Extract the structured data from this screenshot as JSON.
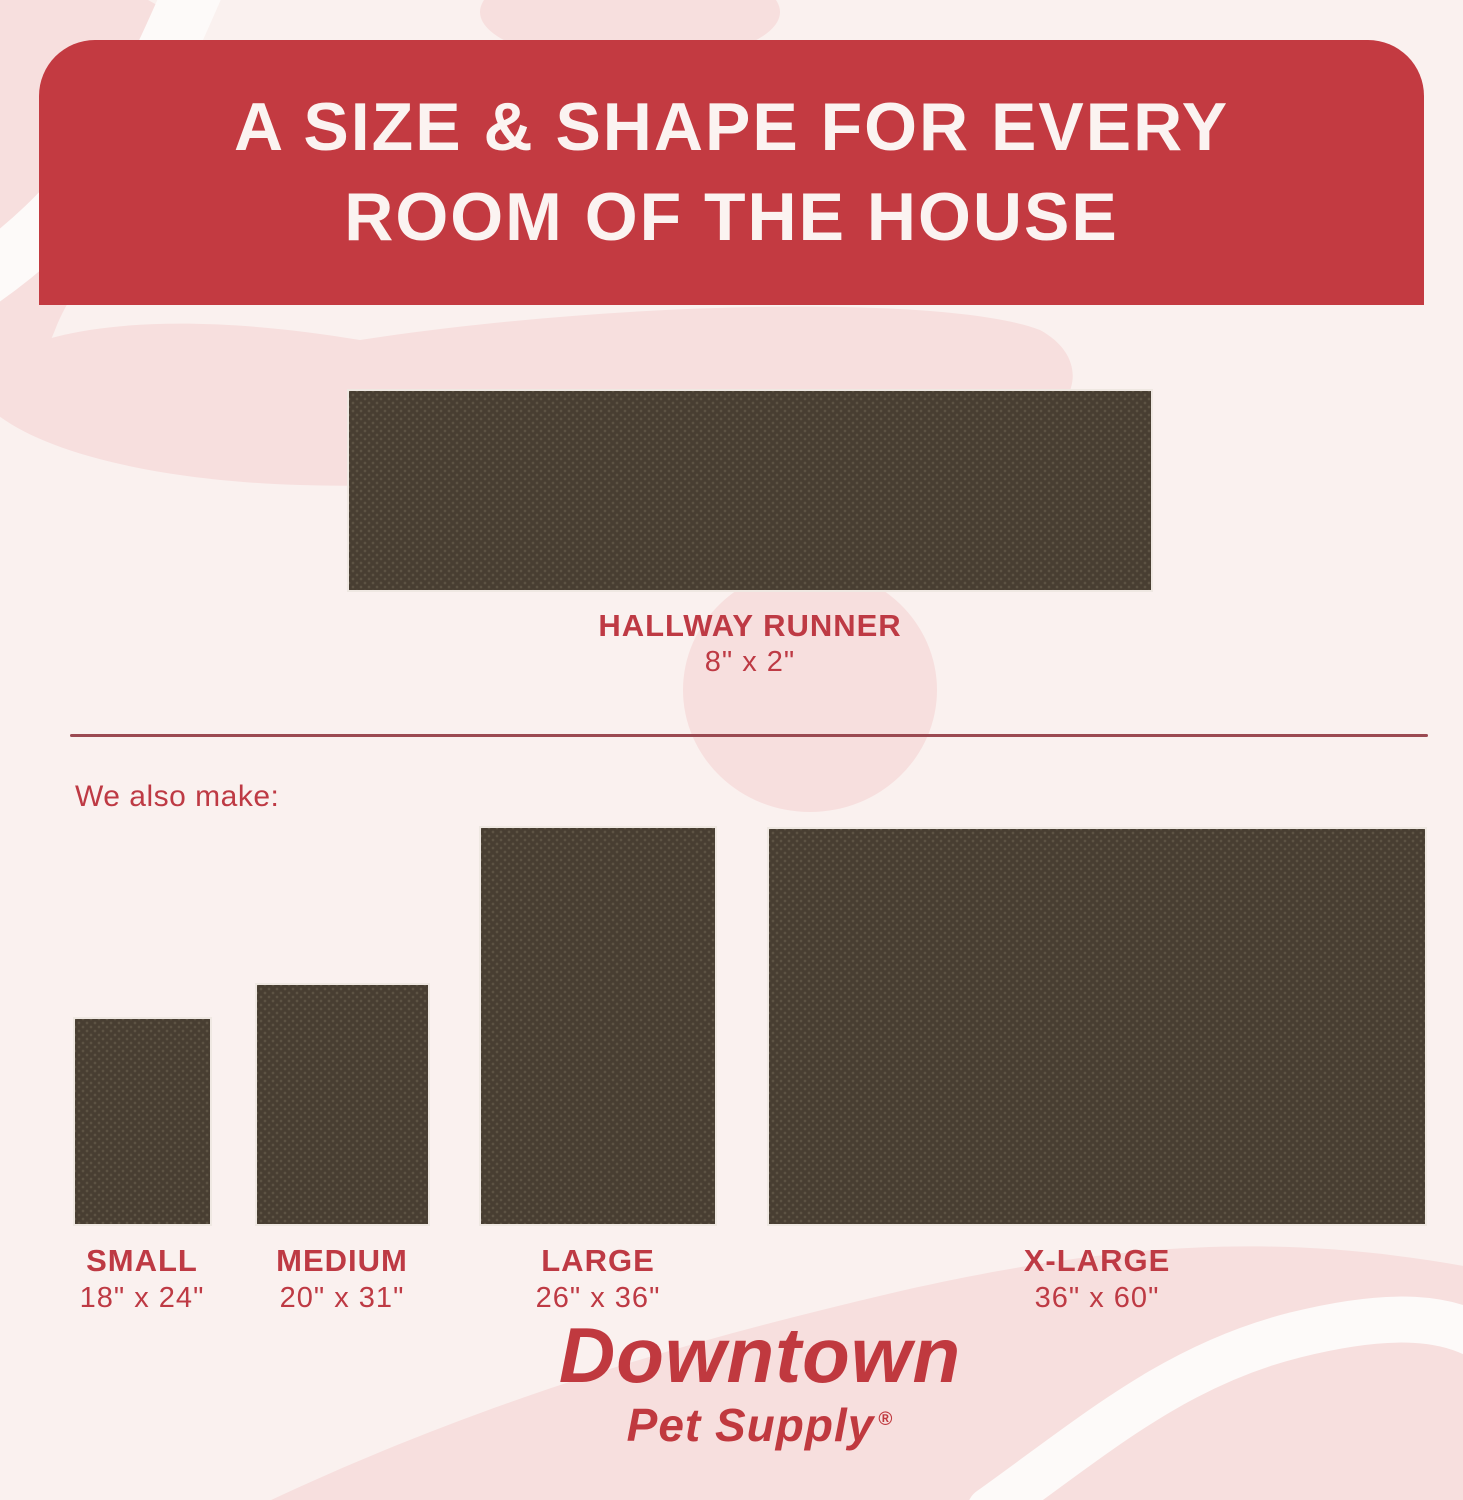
{
  "header": {
    "title_line1": "A SIZE & SHAPE FOR EVERY",
    "title_line2": "ROOM OF THE HOUSE"
  },
  "runner": {
    "name": "HALLWAY RUNNER",
    "size": "8\" x 2\""
  },
  "also_make_label": "We also make:",
  "products": [
    {
      "name": "SMALL",
      "size": "18\" x 24\""
    },
    {
      "name": "MEDIUM",
      "size": "20\" x 31\""
    },
    {
      "name": "LARGE",
      "size": "26\" x 36\""
    },
    {
      "name": "X-LARGE",
      "size": "36\" x 60\""
    }
  ],
  "brand": {
    "name": "Downtown",
    "subname": "Pet Supply",
    "registered": "®"
  },
  "colors": {
    "band_red": "#C33A41",
    "title_text": "#FBF3F1",
    "label_red": "#BE3A44",
    "brand_red": "#C0393F",
    "divider_maroon": "#9B4A52",
    "mat_brown": "#483E32",
    "mat_dot": "#5D5344",
    "background": "#FAF1EF",
    "decoration_pink": "#F7DFDE",
    "decoration_white": "#FDFAF9"
  }
}
